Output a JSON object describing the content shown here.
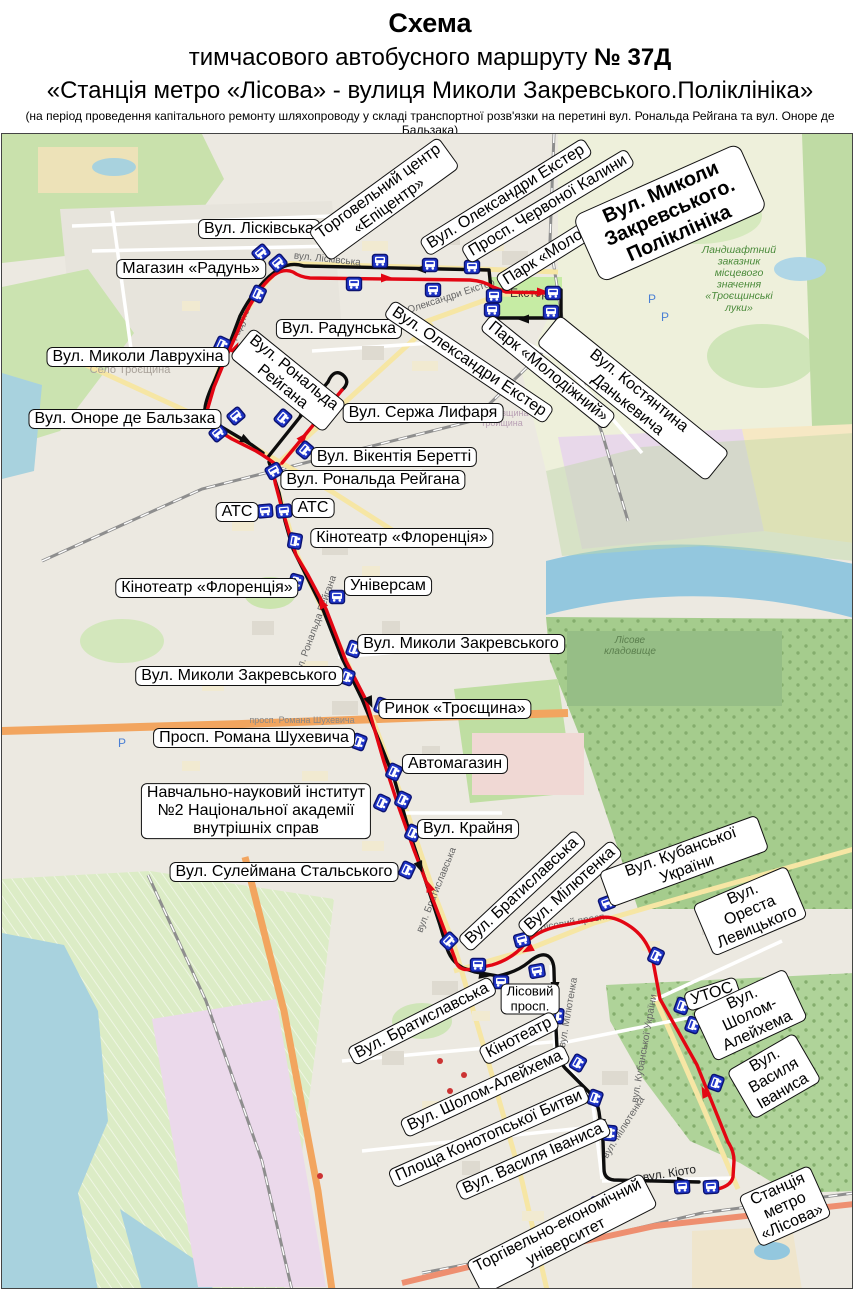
{
  "title": {
    "line1": "Схема",
    "line2_prefix": "тимчасового автобусного маршруту ",
    "line2_bold": "№ 37Д",
    "line3": "«Станція метро «Лісова» - вулиця Миколи Закревського.Поліклініка»",
    "line4": "(на період проведення капітального ремонту шляхопроводу у складі транспортної розв'язки на перетині  вул. Рональда Рейгана та вул. Оноре де Бальзака)"
  },
  "colors": {
    "route_forward": "#e30613",
    "route_return": "#0d0d0d",
    "stop_fill": "#2036c8",
    "stop_border": "#0b1270"
  },
  "map": {
    "top_offset": 133,
    "labels": [
      {
        "t": "Вул. Лісківська",
        "x": 257,
        "y": 228
      },
      {
        "t": "Магазин «Радунь»",
        "x": 189,
        "y": 268
      },
      {
        "t": "Торговельний центр\n«Епіцентр»",
        "x": 382,
        "y": 198,
        "r": -36
      },
      {
        "t": "Вул. Олександри Екстер",
        "x": 504,
        "y": 196,
        "r": -32
      },
      {
        "t": "Просп. Червоної Калини",
        "x": 546,
        "y": 205,
        "r": -31
      },
      {
        "t": "Парк «Молодіжний»",
        "x": 566,
        "y": 241,
        "r": -32
      },
      {
        "t": "Вул. Миколи Закревського.\nПоліклініка",
        "x": 668,
        "y": 212,
        "r": -24,
        "cls": "b"
      },
      {
        "t": "Вул. Радунська",
        "x": 337,
        "y": 328
      },
      {
        "t": "Вул. Миколи Лаврухіна",
        "x": 136,
        "y": 356
      },
      {
        "t": "Вул. Олександри Екстер",
        "x": 467,
        "y": 361,
        "r": 34
      },
      {
        "t": "Парк «Молодіжний»",
        "x": 546,
        "y": 371,
        "r": 39
      },
      {
        "t": "Вул. Костянтина Данькевича",
        "x": 631,
        "y": 397,
        "r": 39
      },
      {
        "t": "Вул. Оноре де Бальзака",
        "x": 123,
        "y": 418
      },
      {
        "t": "Вул. Рональда\nРейгана",
        "x": 286,
        "y": 379,
        "r": 39
      },
      {
        "t": "Вул. Сержа Лифаря",
        "x": 421,
        "y": 412
      },
      {
        "t": "Вул. Вікентія Беретті",
        "x": 392,
        "y": 456
      },
      {
        "t": "Вул. Рональда Рейгана",
        "x": 371,
        "y": 479
      },
      {
        "t": "АТС",
        "x": 235,
        "y": 511
      },
      {
        "t": "АТС",
        "x": 311,
        "y": 507
      },
      {
        "t": "Кінотеатр «Флоренція»",
        "x": 400,
        "y": 537
      },
      {
        "t": "Кінотеатр «Флоренція»",
        "x": 205,
        "y": 587
      },
      {
        "t": "Універсам",
        "x": 386,
        "y": 585
      },
      {
        "t": "Вул. Миколи Закревського",
        "x": 459,
        "y": 643
      },
      {
        "t": "Вул. Миколи Закревського",
        "x": 237,
        "y": 675
      },
      {
        "t": "Ринок «Троєщина»",
        "x": 453,
        "y": 708
      },
      {
        "t": "Просп. Романа Шухевича",
        "x": 252,
        "y": 737
      },
      {
        "t": "Автомагазин",
        "x": 453,
        "y": 763
      },
      {
        "t": "Навчально-науковий інститут\n№2 Національної академії\nвнутрішніх справ",
        "x": 254,
        "y": 810
      },
      {
        "t": "Вул. Крайня",
        "x": 466,
        "y": 828
      },
      {
        "t": "Вул. Сулеймана Стальського",
        "x": 282,
        "y": 871
      },
      {
        "t": "Вул. Братиславська",
        "x": 520,
        "y": 890,
        "r": -43
      },
      {
        "t": "Вул. Мілютенка",
        "x": 568,
        "y": 888,
        "r": -42
      },
      {
        "t": "Вул. Кубанської України",
        "x": 682,
        "y": 860,
        "r": -20
      },
      {
        "t": "Вул. Ореста Левицького",
        "x": 748,
        "y": 910,
        "r": -23
      },
      {
        "t": "УТОС",
        "x": 710,
        "y": 993,
        "r": -18
      },
      {
        "t": "Вул. Шолом-\nАлейхема",
        "x": 748,
        "y": 1014,
        "r": -25
      },
      {
        "t": "Вул. Василя\nІваниса",
        "x": 772,
        "y": 1075,
        "r": -30
      },
      {
        "t": "Вул. Братиславська",
        "x": 420,
        "y": 1020,
        "r": -27
      },
      {
        "t": "Лісовий\nпросп.",
        "x": 528,
        "y": 998,
        "cls": "s"
      },
      {
        "t": "Кінотеатр",
        "x": 517,
        "y": 1037,
        "r": -27
      },
      {
        "t": "Вул. Шолом-Алейхема",
        "x": 483,
        "y": 1090,
        "r": -25
      },
      {
        "t": "Площа Конотопської Битви",
        "x": 487,
        "y": 1135,
        "r": -24
      },
      {
        "t": "Вул. Василя Іваниса",
        "x": 531,
        "y": 1158,
        "r": -24
      },
      {
        "t": "Торгівельно-економічний\nуніверситет",
        "x": 560,
        "y": 1233,
        "r": -27
      },
      {
        "t": "Станція метро\n«Лісова»",
        "x": 783,
        "y": 1205,
        "r": -24
      }
    ],
    "street_texts": [
      {
        "t": "Радунська",
        "x": 244,
        "y": 318,
        "r": -68,
        "c": "#666",
        "fs": 10
      },
      {
        "t": "вул. Лісківська",
        "x": 325,
        "y": 261,
        "r": 6,
        "c": "#666",
        "fs": 10
      },
      {
        "t": "Екстер",
        "x": 527,
        "y": 296,
        "r": 0,
        "c": "#333",
        "fs": 12
      },
      {
        "t": "Олександри Екстер",
        "x": 450,
        "y": 298,
        "r": -18,
        "c": "#666",
        "fs": 10
      },
      {
        "t": "вул. Рональда Рейгана",
        "x": 316,
        "y": 626,
        "r": -70,
        "c": "#666",
        "fs": 10
      },
      {
        "t": "вул. Братиславська",
        "x": 437,
        "y": 890,
        "r": -68,
        "c": "#666",
        "fs": 10
      },
      {
        "t": "Лісовий просп.",
        "x": 572,
        "y": 924,
        "r": -10,
        "c": "#666",
        "fs": 10
      },
      {
        "t": "вул. Мілютенка",
        "x": 569,
        "y": 1012,
        "r": -80,
        "c": "#666",
        "fs": 10
      },
      {
        "t": "вул. Мілютенка",
        "x": 624,
        "y": 1128,
        "r": -58,
        "c": "#666",
        "fs": 10
      },
      {
        "t": "вул. Кубанської України",
        "x": 645,
        "y": 1048,
        "r": -80,
        "c": "#666",
        "fs": 10
      },
      {
        "t": "вул. Кіото",
        "x": 668,
        "y": 1176,
        "r": -9,
        "c": "#222",
        "fs": 12
      },
      {
        "t": "Село Троєщина",
        "x": 128,
        "y": 372,
        "r": 0,
        "c": "#a9a29a",
        "fs": 11
      },
      {
        "t": "Ландшафтний\nзаказник\nмісцевого\nзначення\n«Троєщинські\nлуки»",
        "x": 737,
        "y": 252,
        "r": 0,
        "c": "#4a8a3a",
        "fs": 10.5,
        "i": 1
      },
      {
        "t": "Лісове\nкладовище",
        "x": 628,
        "y": 642,
        "r": 0,
        "c": "#5b7f4e",
        "fs": 10,
        "i": 1
      },
      {
        "t": "просп. Романа Шухевича",
        "x": 300,
        "y": 722,
        "r": 0,
        "c": "#888",
        "fs": 9
      },
      {
        "t": "Вигурівщина\nтройщина",
        "x": 500,
        "y": 415,
        "r": 0,
        "c": "#b9a0b5",
        "fs": 9
      },
      {
        "t": "P",
        "x": 650,
        "y": 302,
        "r": 0,
        "c": "#4a7fd4",
        "fs": 12
      },
      {
        "t": "P",
        "x": 663,
        "y": 320,
        "r": 0,
        "c": "#4a7fd4",
        "fs": 12
      },
      {
        "t": "P",
        "x": 120,
        "y": 746,
        "r": 0,
        "c": "#4a7fd4",
        "fs": 12
      }
    ],
    "routes": {
      "red": [
        "M711,1189 Q729,1186 731,1176 L732,1160 Q732,1150 726,1141 L695,1064 L658,998 L651,960 Q646,938 629,926 Q609,912 594,918 L558,925 Q533,930 522,944 Q510,958 490,964 L470,968 Q456,971 453,958 L445,936 L428,891 L412,849 L396,804 L382,761 L364,699 L344,660 L324,608 L306,574 L294,554 L286,528 L279,504 L274,485 Q270,472 277,464",
        "M280,462 L340,389",
        "M277,466 Q266,457 254,450 L230,438 L212,427 Q203,421 205,410 L212,386 L226,352 L235,332 Q243,311 253,296 Q262,282 272,274 Q282,267 291,271 Q298,276 308,277 L468,279 Q482,280 491,286 L504,291 L547,292"
      ],
      "black": [
        "M550,289 L559,289 L559,317 L493,317 L489,288 L487,269 L302,265 Q289,261 279,267 Q267,274 257,286 Q246,299 238,315 L226,347 L212,381 Q204,398 203,407 Q202,414 208,419 L228,431 L250,444 L261,452",
        "M266,456 L326,381",
        "M326,381 Q332,367 341,374 Q349,381 340,389",
        "M267,461 Q272,476 277,492 L283,520 L291,548 L303,572 L320,606 L340,657 L360,698 L378,742 L392,777 L407,830 L423,878 L438,924 L444,944 Q448,960 461,967 L473,971 L496,975 Q515,971 527,961 Q539,951 546,955 Q552,959 552,970 L553,1007 L555,1047 Q556,1059 563,1067 L587,1091 Q595,1099 597,1111 L601,1140 L602,1168 Q602,1178 612,1179 L697,1181"
      ]
    },
    "arrows": [
      {
        "x": 390,
        "y": 277,
        "r": 0,
        "c": "red"
      },
      {
        "x": 546,
        "y": 291,
        "r": 0,
        "c": "red"
      },
      {
        "x": 236,
        "y": 342,
        "r": -66,
        "c": "red"
      },
      {
        "x": 305,
        "y": 432,
        "r": -50,
        "c": "red"
      },
      {
        "x": 327,
        "y": 404,
        "r": -50,
        "c": "red"
      },
      {
        "x": 425,
        "y": 880,
        "r": -110,
        "c": "red"
      },
      {
        "x": 521,
        "y": 951,
        "r": 152,
        "c": "red"
      },
      {
        "x": 700,
        "y": 1086,
        "r": -115,
        "c": "red"
      },
      {
        "x": 317,
        "y": 597,
        "r": -118,
        "c": "red"
      },
      {
        "x": 413,
        "y": 268,
        "r": 180,
        "c": "black"
      },
      {
        "x": 516,
        "y": 318,
        "r": 180,
        "c": "black"
      },
      {
        "x": 297,
        "y": 415,
        "r": 130,
        "c": "black"
      },
      {
        "x": 249,
        "y": 442,
        "r": 28,
        "c": "black"
      },
      {
        "x": 370,
        "y": 706,
        "r": 67,
        "c": "black"
      },
      {
        "x": 420,
        "y": 871,
        "r": 68,
        "c": "black"
      },
      {
        "x": 488,
        "y": 975,
        "r": 8,
        "c": "black"
      },
      {
        "x": 553,
        "y": 992,
        "r": 90,
        "c": "black"
      },
      {
        "x": 599,
        "y": 1129,
        "r": 92,
        "c": "black"
      },
      {
        "x": 686,
        "y": 1180,
        "r": 0,
        "c": "black"
      }
    ],
    "stops": [
      [
        259,
        252,
        -40
      ],
      [
        276,
        262,
        -40
      ],
      [
        378,
        260,
        0
      ],
      [
        352,
        283,
        0
      ],
      [
        428,
        264,
        0
      ],
      [
        470,
        266,
        0
      ],
      [
        431,
        289,
        0
      ],
      [
        492,
        295,
        0
      ],
      [
        490,
        309,
        0
      ],
      [
        551,
        292,
        0
      ],
      [
        549,
        311,
        0
      ],
      [
        256,
        293,
        -65
      ],
      [
        250,
        346,
        -65
      ],
      [
        220,
        344,
        -65
      ],
      [
        234,
        415,
        -40
      ],
      [
        216,
        432,
        -40
      ],
      [
        281,
        417,
        -50
      ],
      [
        303,
        449,
        -50
      ],
      [
        272,
        470,
        -30
      ],
      [
        263,
        510,
        -5
      ],
      [
        282,
        510,
        -5
      ],
      [
        293,
        540,
        -80
      ],
      [
        294,
        581,
        -75
      ],
      [
        335,
        596,
        0
      ],
      [
        352,
        648,
        -70
      ],
      [
        345,
        676,
        -70
      ],
      [
        380,
        705,
        -70
      ],
      [
        357,
        741,
        -70
      ],
      [
        392,
        771,
        -65
      ],
      [
        380,
        802,
        -65
      ],
      [
        401,
        799,
        -65
      ],
      [
        411,
        832,
        -65
      ],
      [
        405,
        869,
        -65
      ],
      [
        447,
        940,
        -45
      ],
      [
        476,
        964,
        0
      ],
      [
        499,
        981,
        0
      ],
      [
        535,
        970,
        -10
      ],
      [
        520,
        939,
        -15
      ],
      [
        605,
        902,
        -20
      ],
      [
        654,
        955,
        -65
      ],
      [
        680,
        1005,
        -70
      ],
      [
        691,
        1024,
        -70
      ],
      [
        714,
        1082,
        -70
      ],
      [
        555,
        1015,
        -85
      ],
      [
        576,
        1062,
        -60
      ],
      [
        593,
        1097,
        -70
      ],
      [
        608,
        1132,
        -85
      ],
      [
        597,
        1202,
        -5
      ],
      [
        680,
        1186,
        -3
      ],
      [
        709,
        1186,
        -3
      ]
    ]
  }
}
